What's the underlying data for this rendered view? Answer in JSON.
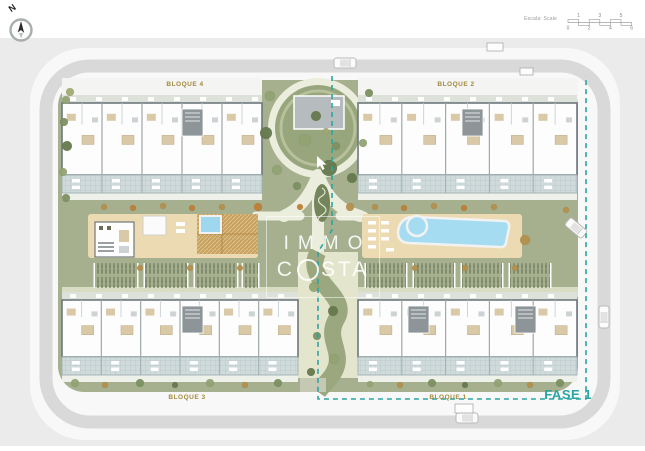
{
  "compass": {
    "label": "N"
  },
  "scale_bar": {
    "label": "Escala: Scale",
    "top_ticks": [
      "1",
      "3",
      "5"
    ],
    "bottom_ticks": [
      "0",
      "2",
      "4",
      "6"
    ]
  },
  "blocks": [
    {
      "id": "bloque-4",
      "label": "BLOQUE 4"
    },
    {
      "id": "bloque-2",
      "label": "BLOQUE 2"
    },
    {
      "id": "bloque-3",
      "label": "BLOQUE 3"
    },
    {
      "id": "bloque-1",
      "label": "BLOQUE 1"
    }
  ],
  "phase": {
    "label": "FASE 1"
  },
  "watermark": {
    "line1": "IMMO",
    "line2_pre": "C",
    "line2_o": "O",
    "line2_post": "STA"
  },
  "colors": {
    "surroundings": "#ebebeb",
    "road_white": "#f8f8f8",
    "asphalt": "#d9d9d9",
    "site_green": "#a6b08e",
    "apron_white": "#f4f4f2",
    "circle_green": "#98a67e",
    "circle_ring": "#b9c19c",
    "path_cream": "#eceedd",
    "corridor_cream": "#e3e6cc",
    "corridor_green": "#9aa77f",
    "walk_pale": "#d8dcc2",
    "deck_sand": "#ecdbb2",
    "wood": "#c9a261",
    "wood_light": "#e0c792",
    "pool_blue": "#a6dcf2",
    "pool_edge": "#f2f2f2",
    "spa_blue": "#9fd8ee",
    "terrace_tile": "#cfdadb",
    "terrace_grid": "#b7c5c7",
    "terrace_edge": "#9fb0b2",
    "building_wall": "#6e787c",
    "room_white": "#fdfdfd",
    "unit_line": "#9fa8aa",
    "beige": "#d9c9a6",
    "beige_dark": "#b8a67f",
    "core_gray": "#8d9599",
    "roof_strip": "#dce1da",
    "chip_white": "#ffffff",
    "plant_dark": "#5a654c",
    "structure_gray": "#b6bcbe",
    "label_gold": "#a3893c",
    "teal": "#2ba5a2",
    "dotted": "#9aa086",
    "car_body": "#fbfbfb",
    "car_stroke": "#b9b9b9",
    "car_glass": "#e2e2e2",
    "box_stroke": "#aaaaaa",
    "ramp_gray": "#c5c9b4",
    "feature_green": "#74855c",
    "feature_spiral": "#e8ead8",
    "compass_ring": "#a8adad",
    "compass_needle": "#2c2c2c",
    "compass_tail": "#bdbdbd",
    "scale_gray": "#999999",
    "scale_text": "#888888",
    "tree_palette": [
      "#7d9161",
      "#93a473",
      "#66794d",
      "#a2aa70",
      "#b5904c",
      "#bf7f35"
    ]
  },
  "landscape": {
    "trees": [
      [
        66,
        100,
        4,
        1
      ],
      [
        64,
        122,
        4,
        0
      ],
      [
        67,
        146,
        5,
        2
      ],
      [
        63,
        172,
        4,
        1
      ],
      [
        66,
        198,
        4,
        0
      ],
      [
        70,
        92,
        4,
        3
      ],
      [
        270,
        96,
        5,
        1
      ],
      [
        369,
        93,
        4,
        0
      ],
      [
        266,
        133,
        6,
        2
      ],
      [
        277,
        170,
        5,
        1
      ],
      [
        297,
        186,
        4,
        0
      ],
      [
        352,
        178,
        5,
        2
      ],
      [
        363,
        143,
        4,
        1
      ],
      [
        258,
        207,
        4,
        5
      ],
      [
        350,
        207,
        4,
        4
      ],
      [
        300,
        207,
        3,
        5
      ],
      [
        316,
        116,
        5,
        2
      ],
      [
        305,
        140,
        6,
        1
      ],
      [
        336,
        146,
        4,
        0
      ],
      [
        326,
        131,
        3,
        3
      ],
      [
        329,
        168,
        8,
        2
      ],
      [
        314,
        287,
        5,
        1
      ],
      [
        333,
        311,
        5,
        2
      ],
      [
        317,
        336,
        4,
        0
      ],
      [
        334,
        359,
        5,
        1
      ],
      [
        311,
        372,
        4,
        2
      ],
      [
        104,
        207,
        3,
        4
      ],
      [
        133,
        208,
        3,
        5
      ],
      [
        163,
        206,
        3,
        4
      ],
      [
        192,
        208,
        3,
        5
      ],
      [
        222,
        207,
        3,
        4
      ],
      [
        375,
        207,
        3,
        4
      ],
      [
        404,
        208,
        3,
        5
      ],
      [
        434,
        206,
        3,
        4
      ],
      [
        464,
        208,
        3,
        5
      ],
      [
        494,
        207,
        3,
        4
      ],
      [
        140,
        268,
        3,
        4
      ],
      [
        190,
        268,
        3,
        4
      ],
      [
        240,
        268,
        3,
        4
      ],
      [
        415,
        268,
        3,
        4
      ],
      [
        465,
        268,
        3,
        4
      ],
      [
        515,
        268,
        3,
        4
      ],
      [
        75,
        383,
        4,
        1
      ],
      [
        105,
        385,
        3,
        4
      ],
      [
        140,
        383,
        4,
        0
      ],
      [
        175,
        385,
        3,
        2
      ],
      [
        210,
        383,
        4,
        1
      ],
      [
        245,
        385,
        3,
        4
      ],
      [
        278,
        383,
        4,
        0
      ],
      [
        370,
        384,
        3,
        1
      ],
      [
        400,
        385,
        3,
        4
      ],
      [
        432,
        383,
        4,
        0
      ],
      [
        465,
        385,
        3,
        2
      ],
      [
        498,
        383,
        4,
        1
      ],
      [
        530,
        385,
        3,
        4
      ],
      [
        560,
        383,
        4,
        0
      ],
      [
        525,
        240,
        5,
        4
      ],
      [
        566,
        210,
        3,
        4
      ]
    ]
  },
  "vehicles": [
    {
      "x": 345,
      "y": 63,
      "angle": 0
    },
    {
      "x": 467,
      "y": 418,
      "angle": 0
    },
    {
      "x": 576,
      "y": 228,
      "angle": 40
    },
    {
      "x": 604,
      "y": 317,
      "angle": 90
    }
  ],
  "utility_boxes": [
    {
      "x": 487,
      "y": 43,
      "w": 16,
      "h": 8
    },
    {
      "x": 520,
      "y": 68,
      "w": 13,
      "h": 7
    },
    {
      "x": 455,
      "y": 404,
      "w": 18,
      "h": 9
    }
  ]
}
